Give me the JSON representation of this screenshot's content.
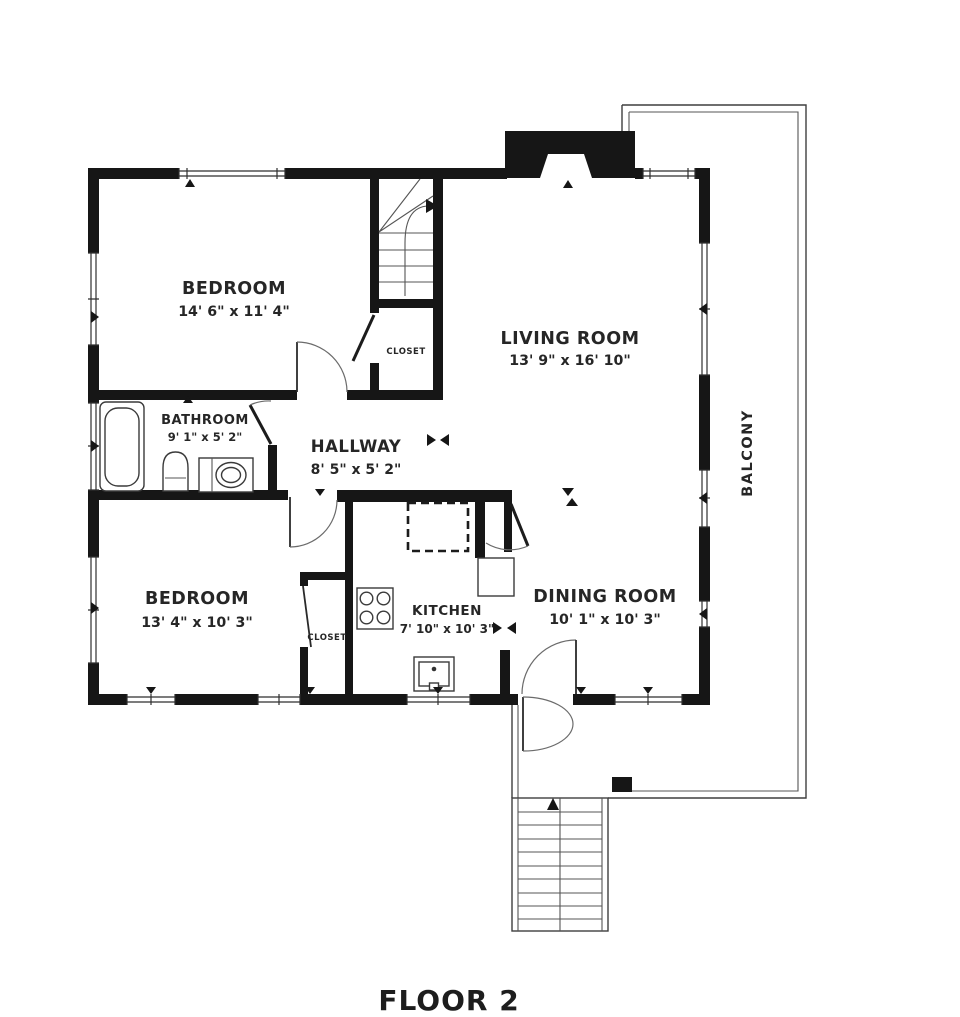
{
  "floor_plan": {
    "title": "FLOOR 2",
    "rooms": {
      "bedroom_1": {
        "name": "BEDROOM",
        "dimensions": "14' 6\" x 11' 4\""
      },
      "living_room": {
        "name": "LIVING ROOM",
        "dimensions": "13' 9\" x 16' 10\""
      },
      "bathroom": {
        "name": "BATHROOM",
        "dimensions": "9' 1\" x 5' 2\""
      },
      "hallway": {
        "name": "HALLWAY",
        "dimensions": "8' 5\" x 5' 2\""
      },
      "bedroom_2": {
        "name": "BEDROOM",
        "dimensions": "13' 4\" x 10' 3\""
      },
      "kitchen": {
        "name": "KITCHEN",
        "dimensions": "7' 10\" x 10' 3\""
      },
      "dining_room": {
        "name": "DINING ROOM",
        "dimensions": "10' 1\" x 10' 3\""
      },
      "closet_hall": {
        "name": "CLOSET"
      },
      "closet_bedroom_2": {
        "name": "CLOSET"
      },
      "balcony": {
        "name": "BALCONY"
      }
    },
    "colors": {
      "walls": "#161616",
      "thin_lines": "#3f3f3f",
      "background": "#ffffff",
      "text": "#262626"
    }
  }
}
